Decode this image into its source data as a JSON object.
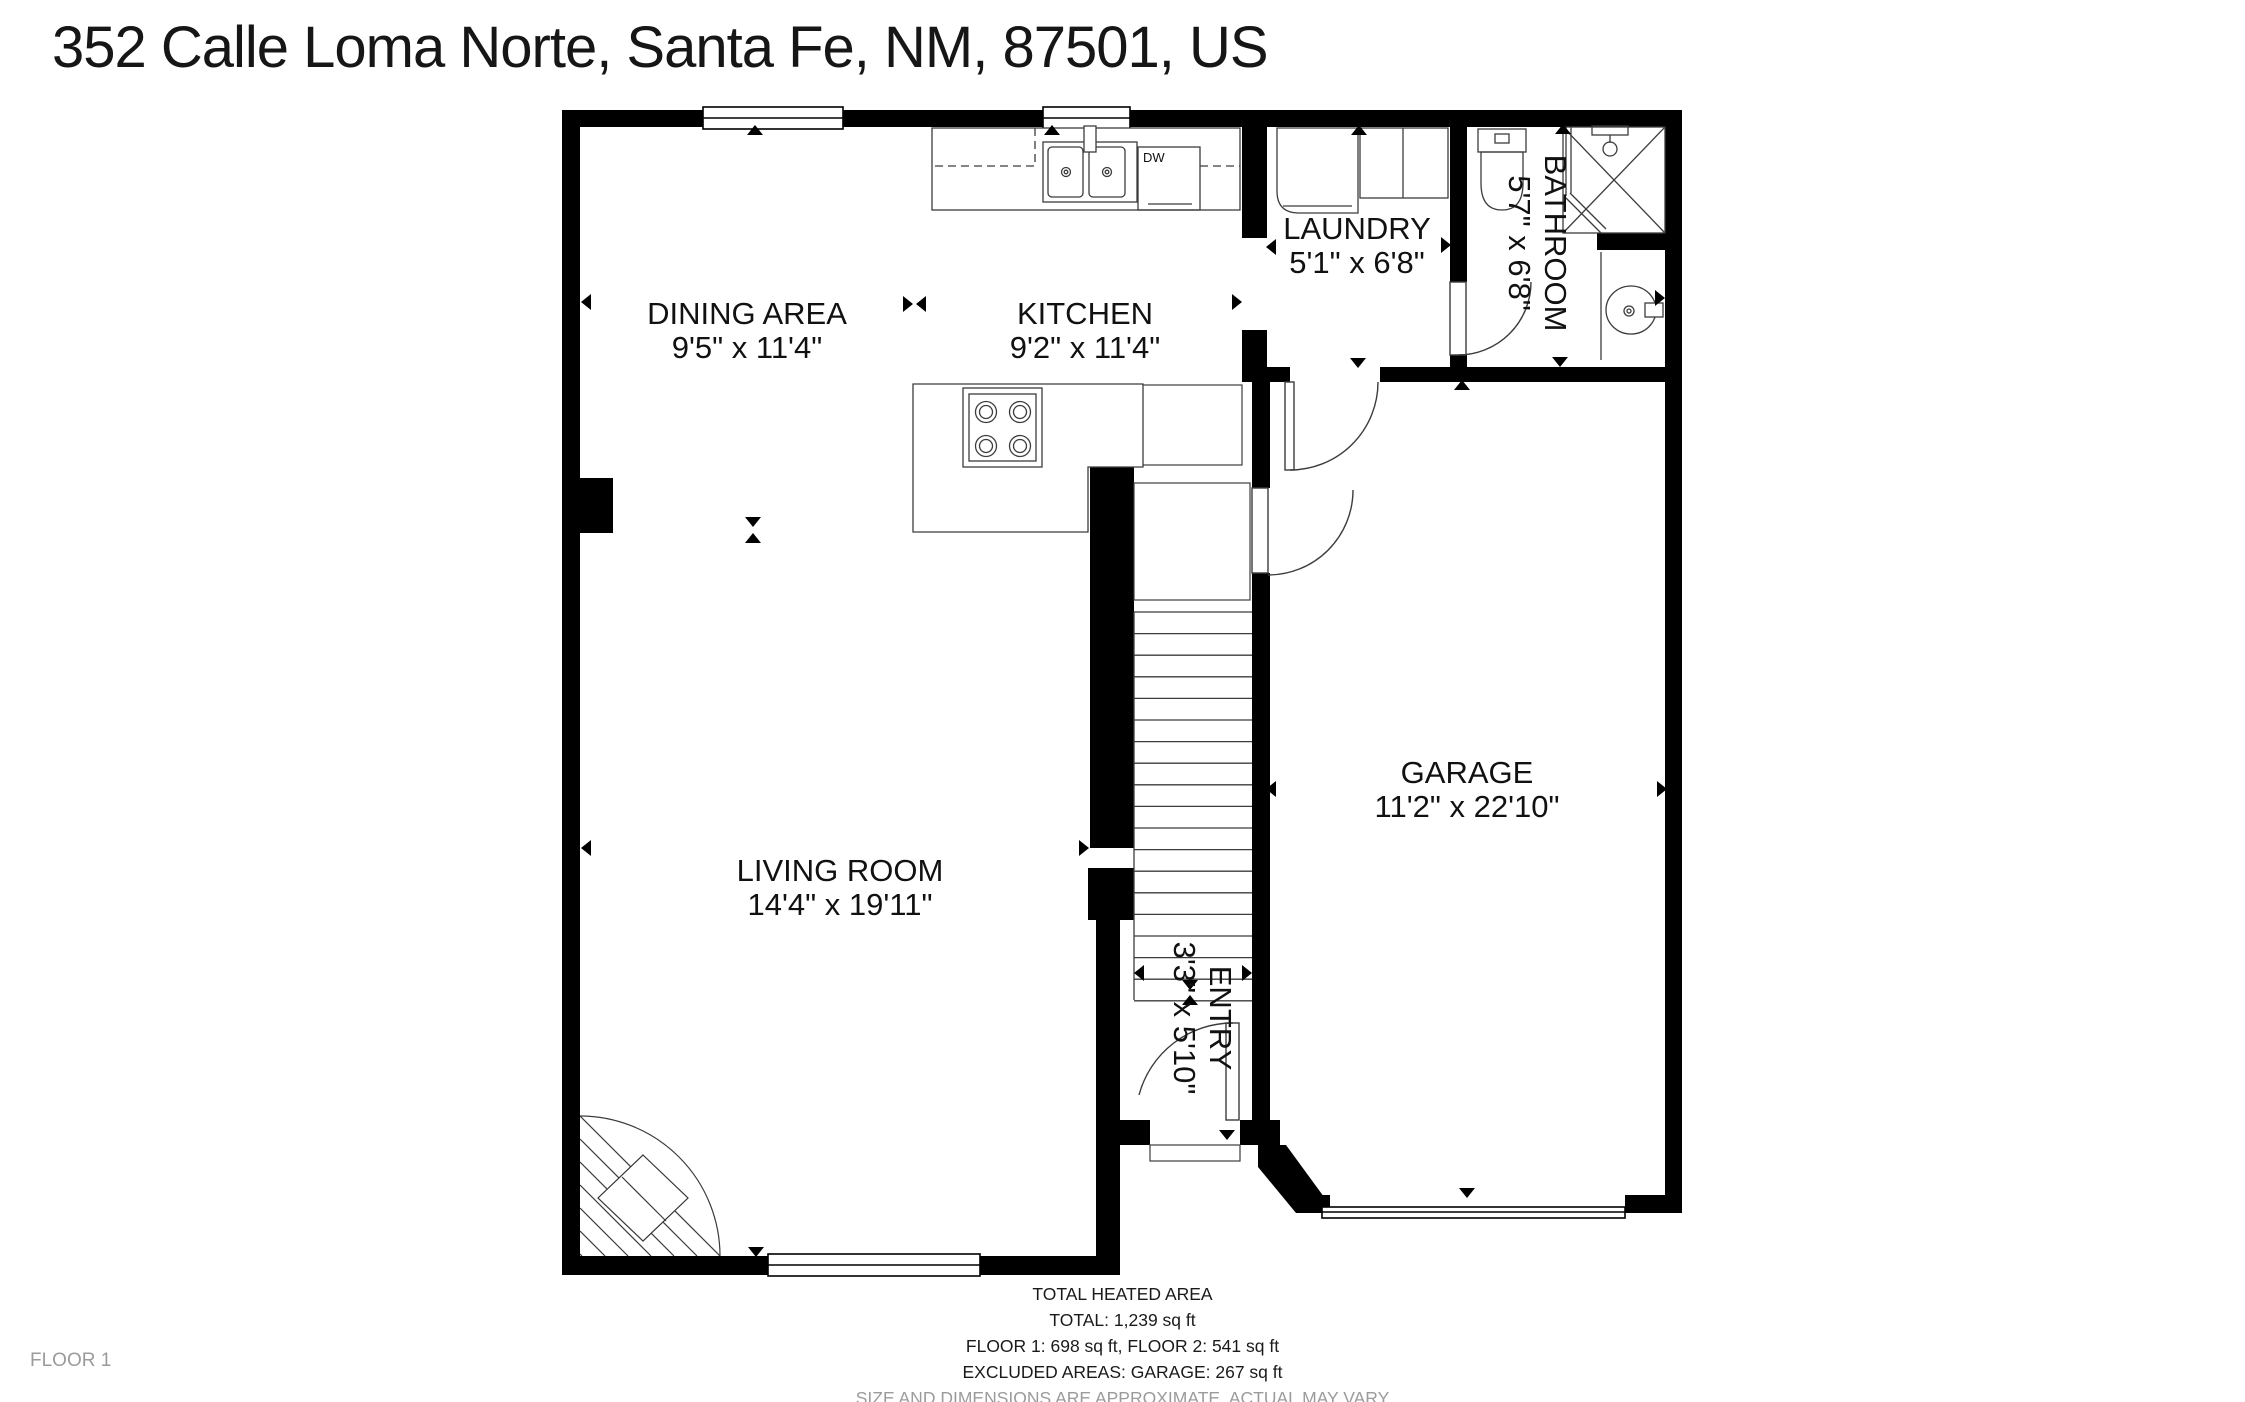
{
  "title": "352 Calle Loma Norte, Santa Fe, NM, 87501, US",
  "floor_badge": "FLOOR 1",
  "footer": {
    "heading": "TOTAL HEATED AREA",
    "total": "TOTAL: 1,239 sq ft",
    "floors": "FLOOR 1: 698 sq ft, FLOOR 2: 541 sq ft",
    "excluded": "EXCLUDED AREAS: GARAGE: 267 sq ft",
    "disclaimer": "SIZE AND DIMENSIONS ARE APPROXIMATE, ACTUAL MAY VARY"
  },
  "appliance_labels": {
    "dishwasher": "DW"
  },
  "colors": {
    "wall": "#000000",
    "line": "#3c3c3c",
    "text": "#1a1a1a",
    "muted": "#9b9b9b"
  },
  "rooms": [
    {
      "id": "dining-area",
      "name": "DINING AREA",
      "dims": "9'5\" x 11'4\"",
      "x": 747,
      "y": 324,
      "rotated": false
    },
    {
      "id": "kitchen",
      "name": "KITCHEN",
      "dims": "9'2\" x 11'4\"",
      "x": 1085,
      "y": 324,
      "rotated": false
    },
    {
      "id": "laundry",
      "name": "LAUNDRY",
      "dims": "5'1\" x 6'8\"",
      "x": 1357,
      "y": 239,
      "rotated": false
    },
    {
      "id": "bathroom",
      "name": "BATHROOM",
      "dims": "5'7\" x 6'8\"",
      "x": 1545,
      "y": 243,
      "rotated": true
    },
    {
      "id": "garage",
      "name": "GARAGE",
      "dims": "11'2\" x 22'10\"",
      "x": 1467,
      "y": 783,
      "rotated": false
    },
    {
      "id": "living-room",
      "name": "LIVING ROOM",
      "dims": "14'4\" x 19'11\"",
      "x": 840,
      "y": 881,
      "rotated": false
    },
    {
      "id": "entry",
      "name": "ENTRY",
      "dims": "3'3\" x 5'10\"",
      "x": 1210,
      "y": 1018,
      "rotated": true
    }
  ]
}
